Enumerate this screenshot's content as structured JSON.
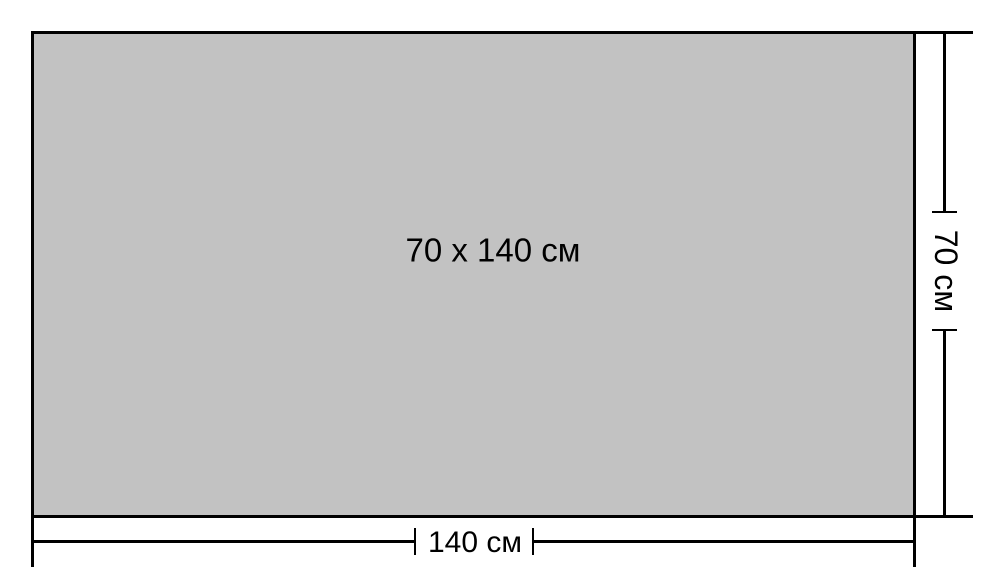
{
  "diagram": {
    "center_label": "70 x 140 см",
    "width_label": "140 см",
    "height_label": "70 см",
    "colors": {
      "fill": "#c2c2c2",
      "line": "#000000",
      "background": "#ffffff"
    }
  }
}
